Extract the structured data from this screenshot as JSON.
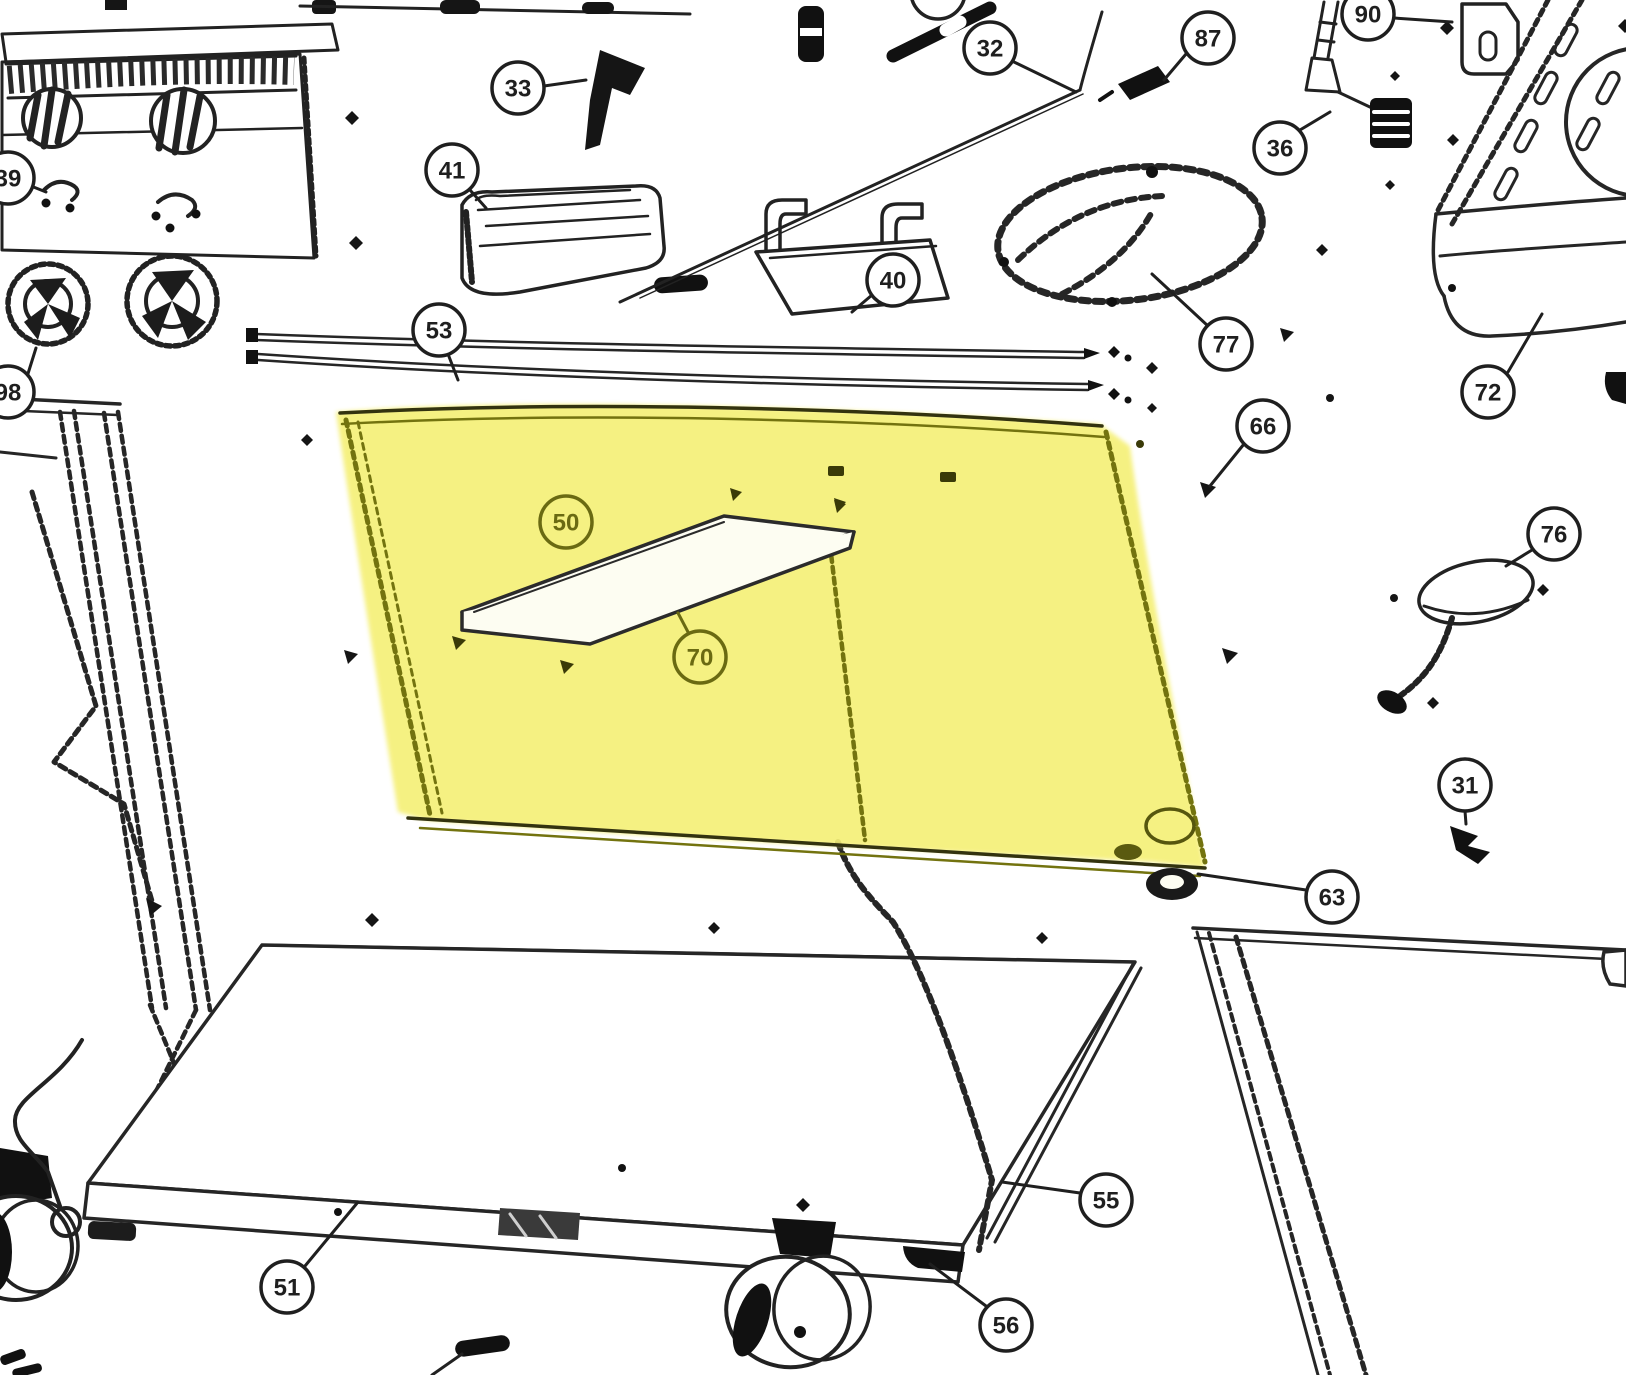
{
  "diagram": {
    "description": "Exploded parts diagram of a grill cart with a highlighted rear panel",
    "colors": {
      "line": "#1f1f1f",
      "olive": "#6a6a12",
      "olive_edge": "#73730f",
      "highlight": "#f5f078",
      "background": "#ffffff"
    },
    "highlighted_callouts": [
      "50",
      "70"
    ],
    "callouts": [
      {
        "id": "39",
        "x": 8,
        "y": 178,
        "leader": [
          26,
          184,
          46,
          192
        ]
      },
      {
        "id": "98",
        "x": 8,
        "y": 392,
        "leader": [
          26,
          380,
          36,
          348
        ]
      },
      {
        "id": "33",
        "x": 518,
        "y": 88,
        "leader": [
          544,
          86,
          586,
          80
        ]
      },
      {
        "id": "41",
        "x": 452,
        "y": 170,
        "leader": [
          470,
          190,
          486,
          208
        ]
      },
      {
        "id": "53",
        "x": 439,
        "y": 330,
        "leader": [
          448,
          354,
          458,
          380
        ]
      },
      {
        "id": "40",
        "x": 893,
        "y": 280,
        "leader": [
          872,
          295,
          852,
          312
        ]
      },
      {
        "id": "32",
        "x": 990,
        "y": 48,
        "leader": [
          1014,
          62,
          1076,
          92
        ]
      },
      {
        "id": "87",
        "x": 1208,
        "y": 38,
        "leader": [
          1186,
          54,
          1164,
          80
        ]
      },
      {
        "id": "90",
        "x": 1368,
        "y": 14,
        "leader": [
          1394,
          18,
          1452,
          22
        ]
      },
      {
        "id": "36",
        "x": 1280,
        "y": 148,
        "leader": [
          1300,
          130,
          1330,
          112
        ]
      },
      {
        "id": "77",
        "x": 1226,
        "y": 344,
        "leader": [
          1208,
          326,
          1152,
          274
        ]
      },
      {
        "id": "72",
        "x": 1488,
        "y": 392,
        "leader": [
          1508,
          372,
          1542,
          314
        ]
      },
      {
        "id": "66",
        "x": 1263,
        "y": 426,
        "leader": [
          1244,
          444,
          1210,
          486
        ]
      },
      {
        "id": "50",
        "x": 566,
        "y": 522,
        "style": "olive"
      },
      {
        "id": "70",
        "x": 700,
        "y": 657,
        "leader": [
          688,
          632,
          678,
          613
        ],
        "style": "olive"
      },
      {
        "id": "76",
        "x": 1554,
        "y": 534,
        "leader": [
          1532,
          550,
          1506,
          566
        ]
      },
      {
        "id": "31",
        "x": 1465,
        "y": 785,
        "leader": [
          1465,
          811,
          1466,
          824
        ]
      },
      {
        "id": "63",
        "x": 1332,
        "y": 897,
        "leader": [
          1306,
          890,
          1198,
          874
        ]
      },
      {
        "id": "55",
        "x": 1106,
        "y": 1200,
        "leader": [
          1080,
          1193,
          1002,
          1182
        ]
      },
      {
        "id": "51",
        "x": 287,
        "y": 1287,
        "leader": [
          305,
          1266,
          358,
          1202
        ]
      },
      {
        "id": "56",
        "x": 1006,
        "y": 1325,
        "leader": [
          986,
          1306,
          930,
          1264
        ]
      }
    ]
  }
}
